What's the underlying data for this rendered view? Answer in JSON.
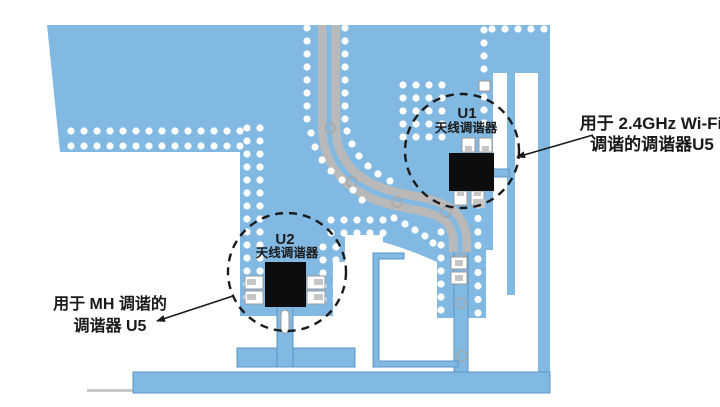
{
  "pcb": {
    "colors": {
      "copper": "#82B9E3",
      "copper_outline": "#5B94C6",
      "trace_gray": "#B9B9B9",
      "via_white": "#FFFFFF",
      "chip_black": "#0D0D0D",
      "ink": "#1A1A1A",
      "edge_gray": "#C9C9C9"
    },
    "components": {
      "u1": {
        "ref": "U1",
        "label": "天线调谐器"
      },
      "u2": {
        "ref": "U2",
        "label": "天线调谐器"
      }
    },
    "annotations": {
      "wifi": {
        "line1": "用于 2.4GHz Wi-Fi",
        "line2": "调谐的调谐器U5"
      },
      "mh": {
        "line1": "用于 MH 调谐的",
        "line2": "调谐器 U5"
      }
    },
    "via_groups": [
      {
        "type": "row",
        "x": 71,
        "y": 131,
        "dx": 13,
        "count": 14
      },
      {
        "type": "row",
        "x": 71,
        "y": 146,
        "dx": 13,
        "count": 14
      },
      {
        "type": "col",
        "x": 307,
        "y": 28,
        "dy": 13,
        "count": 8
      },
      {
        "type": "col",
        "x": 345,
        "y": 28,
        "dy": 13,
        "count": 8
      },
      {
        "type": "col",
        "x": 247,
        "y": 128,
        "dy": 13,
        "count": 14
      },
      {
        "type": "col",
        "x": 260,
        "y": 128,
        "dy": 13,
        "count": 14
      },
      {
        "type": "col",
        "x": 323,
        "y": 247,
        "dy": 13,
        "count": 5
      },
      {
        "type": "col",
        "x": 336,
        "y": 247,
        "dy": 13,
        "count": 5
      },
      {
        "type": "row",
        "x": 331,
        "y": 220,
        "dx": 13,
        "count": 5
      },
      {
        "type": "row",
        "x": 331,
        "y": 233,
        "dx": 13,
        "count": 5
      },
      {
        "type": "col",
        "x": 484,
        "y": 30,
        "dy": 13,
        "count": 4
      },
      {
        "type": "col",
        "x": 484,
        "y": 97,
        "dy": 13,
        "count": 3
      },
      {
        "type": "row",
        "x": 492,
        "y": 29,
        "dx": 13,
        "count": 5
      },
      {
        "type": "col",
        "x": 478,
        "y": 205,
        "dy": 13.5,
        "count": 9
      },
      {
        "type": "col",
        "x": 441,
        "y": 232,
        "dy": 13,
        "count": 8
      },
      {
        "type": "grid",
        "x": 403,
        "y": 85,
        "dx": 13,
        "dy": 13,
        "cols": 4,
        "rows": 5
      },
      {
        "type": "points",
        "pts": [
          [
            311,
            133
          ],
          [
            315,
            147
          ],
          [
            322,
            160
          ],
          [
            331,
            171
          ],
          [
            342,
            180
          ],
          [
            353,
            190
          ],
          [
            362,
            200
          ]
        ]
      },
      {
        "type": "points",
        "pts": [
          [
            347,
            131
          ],
          [
            352,
            144
          ],
          [
            359,
            156
          ],
          [
            368,
            166
          ],
          [
            378,
            174
          ],
          [
            390,
            181
          ]
        ]
      },
      {
        "type": "points",
        "pts": [
          [
            394,
            218
          ],
          [
            405,
            224
          ],
          [
            415,
            230
          ],
          [
            425,
            236
          ],
          [
            433,
            243
          ]
        ]
      }
    ],
    "trace_vias": [
      [
        330,
        128
      ],
      [
        352,
        182
      ],
      [
        397,
        202
      ],
      [
        446,
        212
      ],
      [
        461,
        258
      ],
      [
        461,
        303
      ],
      [
        462,
        356
      ]
    ]
  }
}
